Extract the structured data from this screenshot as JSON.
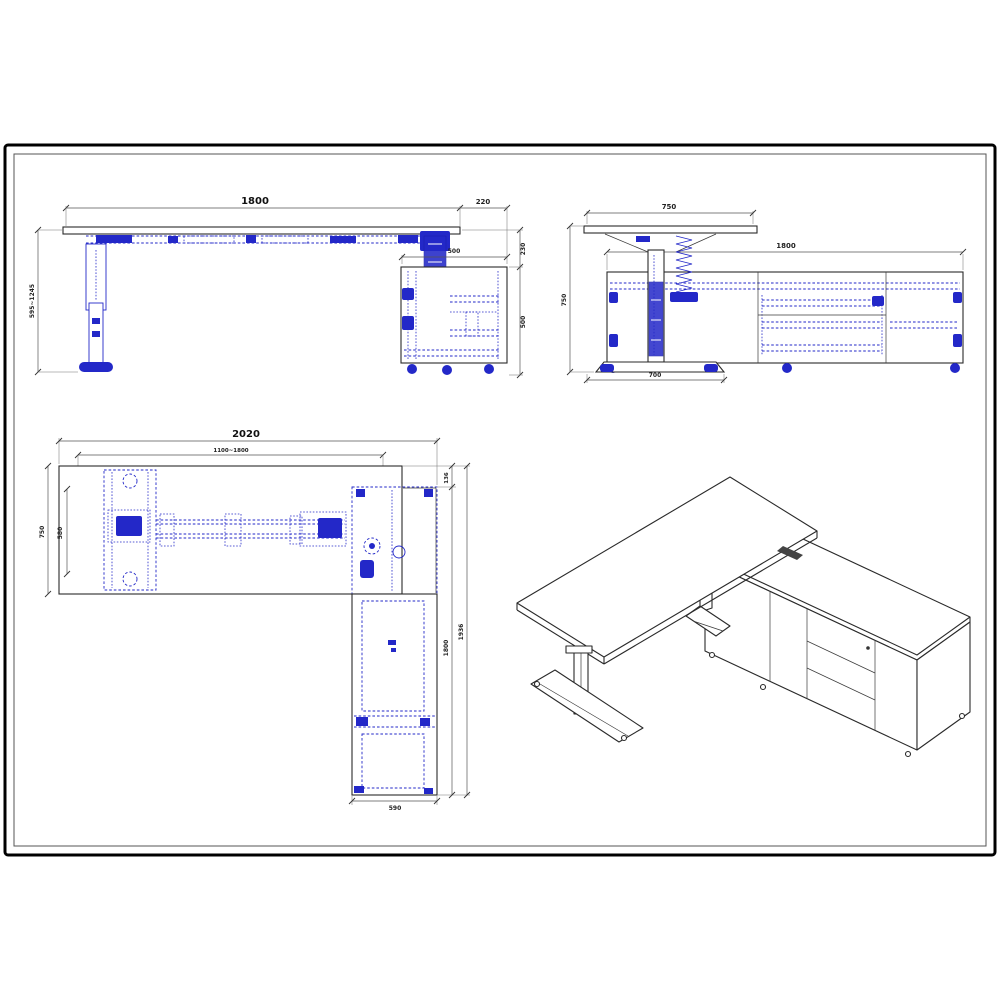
{
  "page": {
    "background": "#ffffff"
  },
  "frame": {
    "outer_color": "#000000",
    "inner_color": "#555555"
  },
  "colors": {
    "main_line": "#2a2a2a",
    "hidden_detail_blue": "#2328c8",
    "dimension_line": "#555555"
  },
  "views": {
    "front_elevation": {
      "name": "front-elevation-view",
      "dimensions": {
        "desk_width": "1800",
        "top_overhang": "220",
        "cabinet_depth": "500",
        "height_range": "595~1245",
        "top_to_cabinet_gap": "230",
        "cabinet_height": "500"
      }
    },
    "side_elevation": {
      "name": "side-elevation-view",
      "dimensions": {
        "desk_depth": "750",
        "cabinet_length": "1800",
        "overall_height": "750",
        "foot_depth": "700"
      }
    },
    "plan": {
      "name": "plan-view",
      "dimensions": {
        "overall_width": "2020",
        "frame_width_range": "1100~1800",
        "desk_depth": "750",
        "leg_frame_depth": "580",
        "back_overhang": "136",
        "cabinet_length": "1800",
        "overall_depth": "1936",
        "cabinet_width": "590"
      }
    },
    "isometric": {
      "name": "isometric-view"
    }
  }
}
